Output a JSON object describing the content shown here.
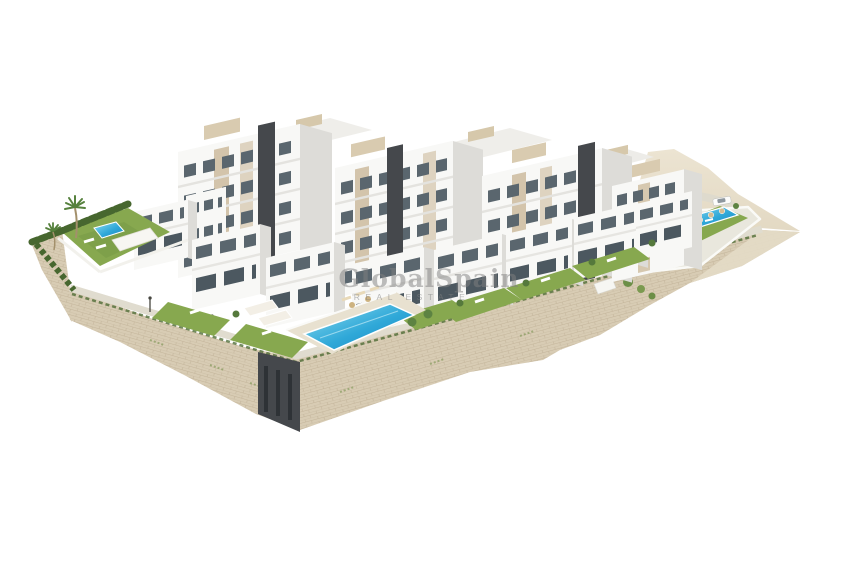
{
  "watermark": {
    "brand": "GlobalSpain",
    "tagline": "REAL ESTATE"
  },
  "scene": {
    "subject": "Aerial 3D architectural render of a hillside residential complex on a white background",
    "features": [
      "white modern apartment blocks with balconies and dark stair towers",
      "stepped townhouses with private lawns",
      "communal swimming pool above a stone retaining wall",
      "second pool with sun umbrellas and parked white car",
      "landscaped garden with hedge, palm trees and private pool",
      "sand-colored slope and masonry retaining walls with street lamps"
    ]
  },
  "palette": {
    "background": "#ffffff",
    "stone": "#d8ccb4",
    "stone-line": "#c3b49a",
    "sand": "#e4dbc7",
    "walkway": "#e0dccf",
    "building-white": "#f8f8f6",
    "building-side": "#dddcd8",
    "glass": "#5a666e",
    "glass-dark": "#4c5860",
    "accent-beige": "#cdbb9d",
    "tower-dark": "#45484c",
    "lawn": "#87a84f",
    "lawn-deep": "#6e9142",
    "hedge": "#47672f",
    "pool-light": "#8fdcef",
    "pool": "#2fa8d8",
    "pool-deep": "#1b84bf",
    "watermark": "#808080"
  }
}
